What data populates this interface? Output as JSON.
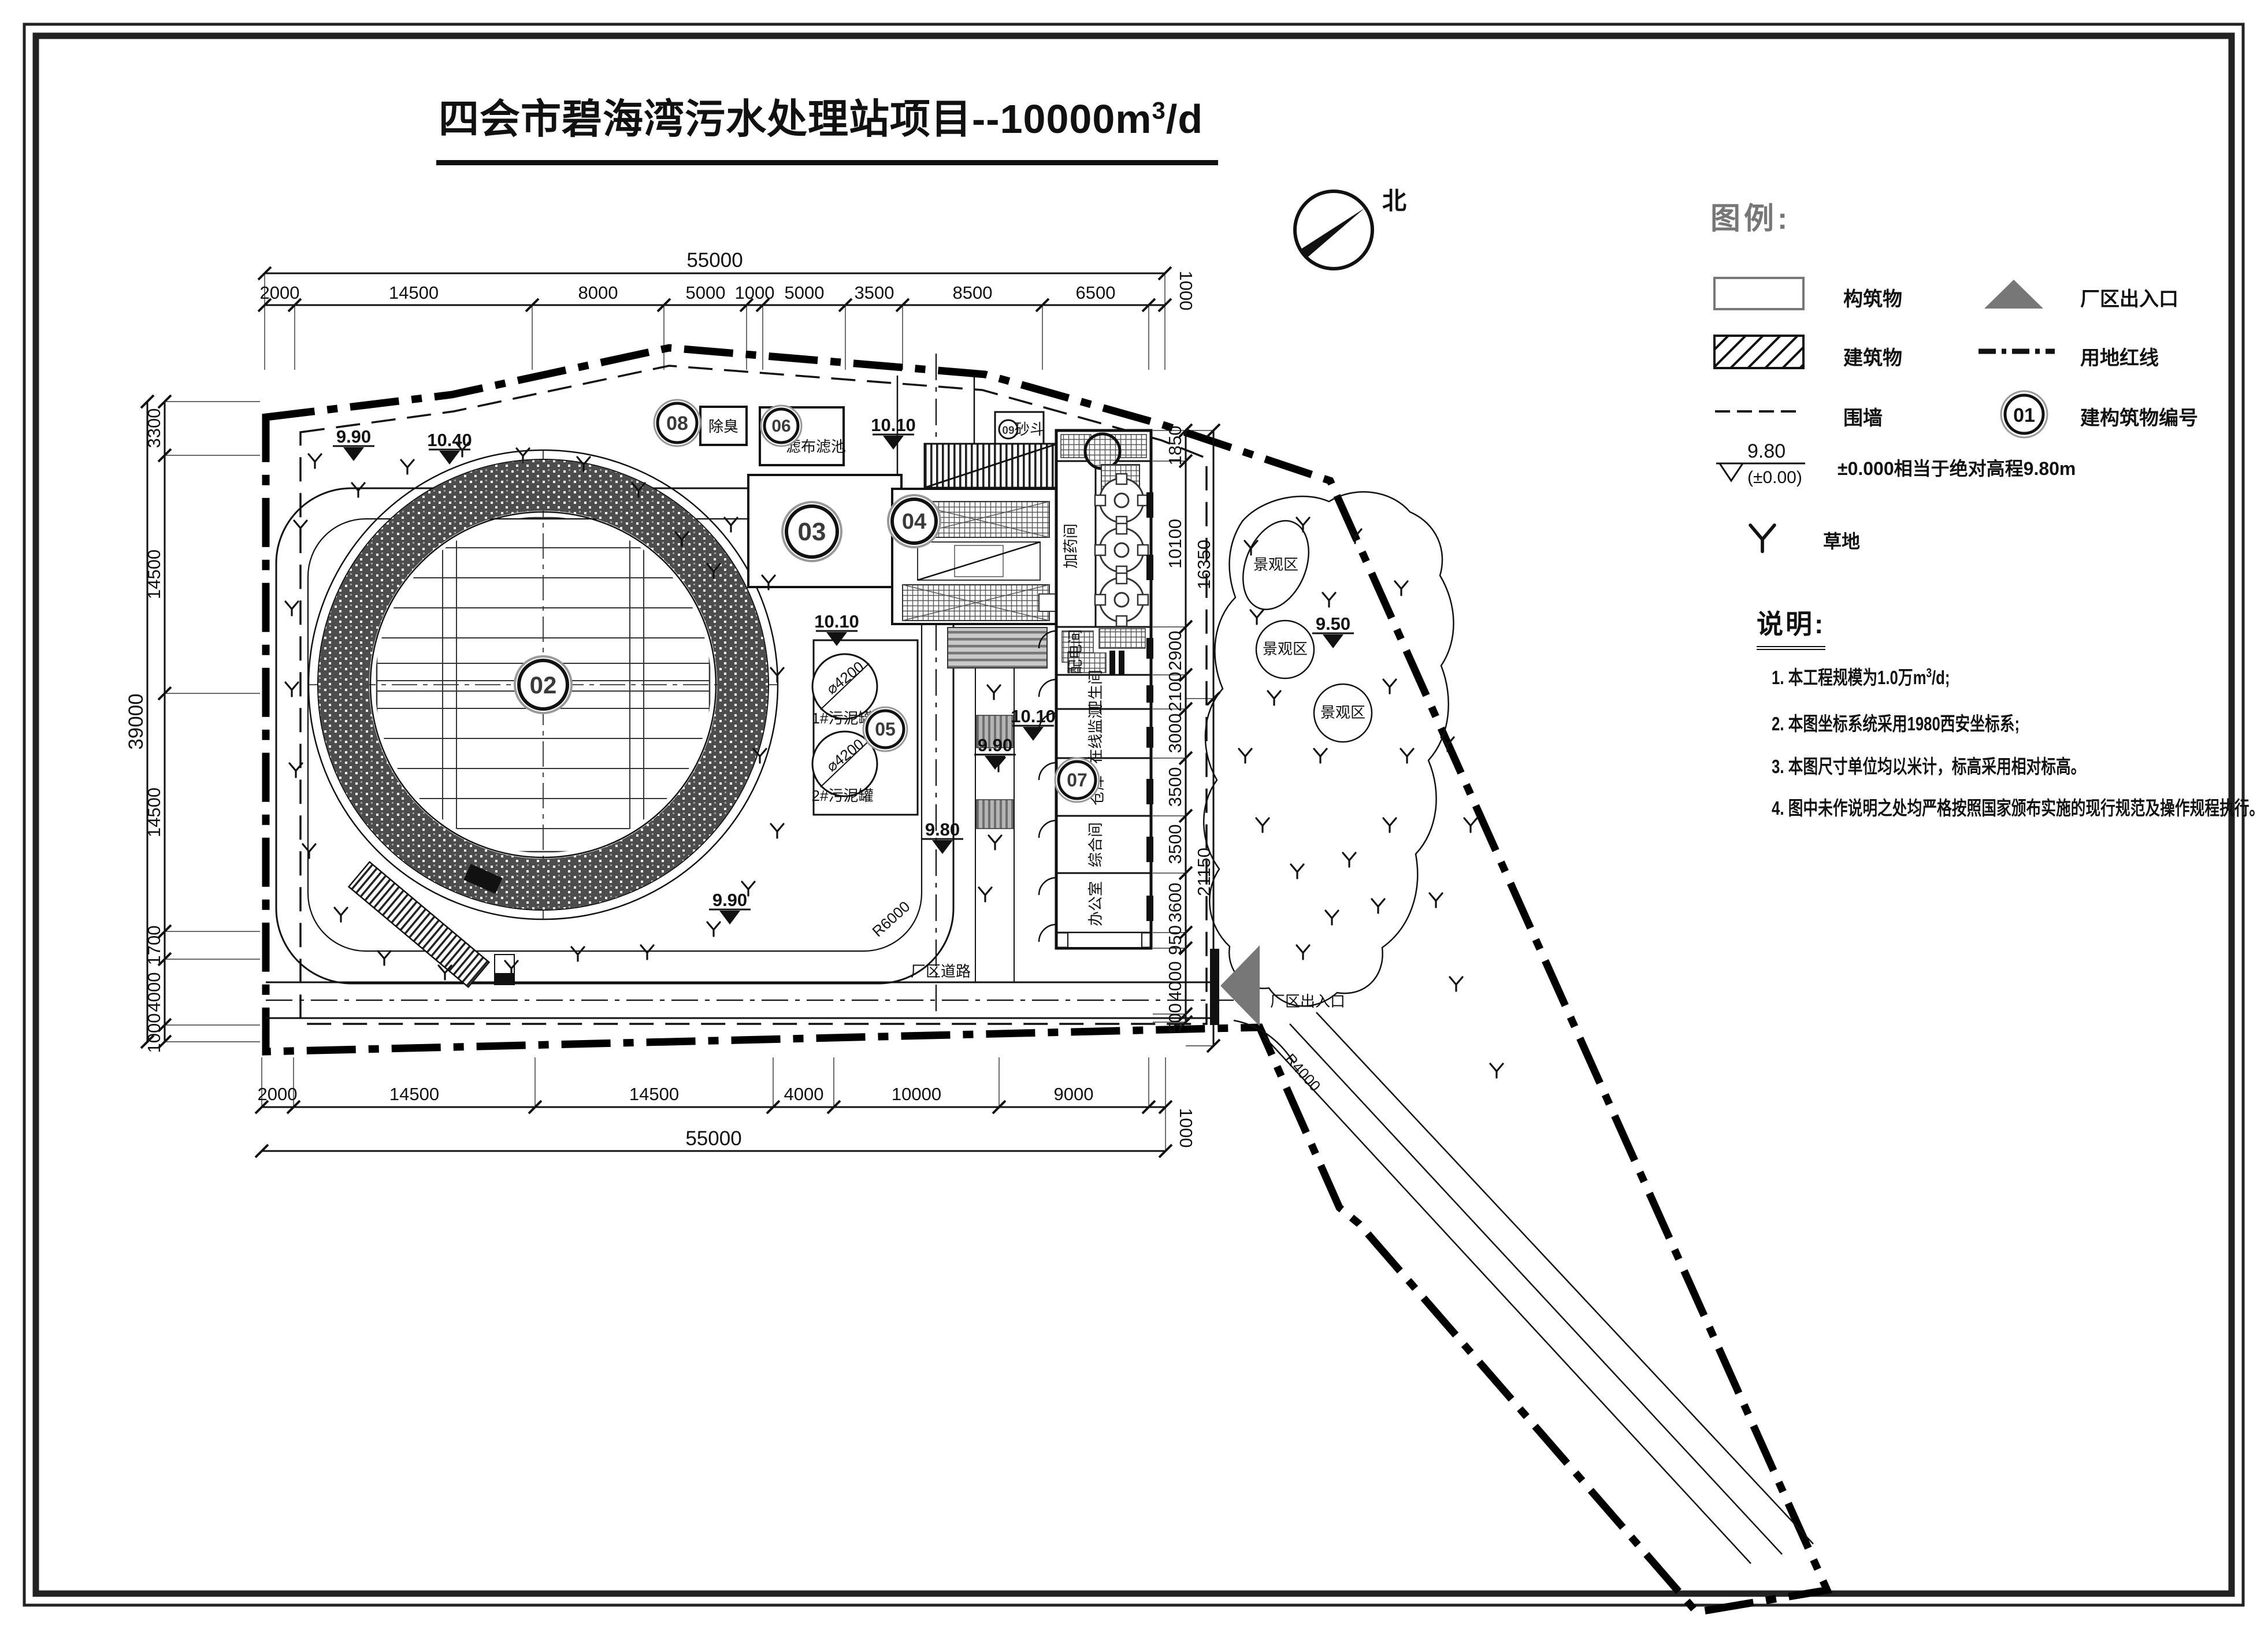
{
  "title": {
    "prefix": "四会市碧海湾污水处理站项目--10000m",
    "sup": "3",
    "suffix": "/d"
  },
  "compass": {
    "north": "北"
  },
  "legend": {
    "heading": "图例:",
    "structure": "构筑物",
    "building": "建筑物",
    "fence": "围墙",
    "entrance": "厂区出入口",
    "boundary": "用地红线",
    "numbering": "建构筑物编号",
    "number_sample": "01",
    "elev_value": "9.80",
    "elev_datum": "(±0.00)",
    "elev_desc": "±0.000相当于绝对高程9.80m",
    "grass": "草地"
  },
  "notes": {
    "heading": "说明:",
    "n1_prefix": "1.  本工程规模为1.0万m",
    "n1_sup": "3",
    "n1_suffix": "/d;",
    "n2": "2.  本图坐标系统采用1980西安坐标系;",
    "n3": "3.  本图尺寸单位均以米计，标高采用相对标高。",
    "n4": "4.  图中未作说明之处均严格按照国家颁布实施的现行规范及操作规程执行。"
  },
  "dims": {
    "top": {
      "total": "55000",
      "right_end": "1000",
      "segments": [
        "2000",
        "14500",
        "8000",
        "5000",
        "1000",
        "5000",
        "3500",
        "8500",
        "6500"
      ]
    },
    "bottom": {
      "total": "55000",
      "right_end": "1000",
      "segments": [
        "2000",
        "14500",
        "14500",
        "4000",
        "10000",
        "9000"
      ]
    },
    "left": {
      "total": "39000",
      "bottom_end": "1000",
      "segments": [
        "3300",
        "14500",
        "14500",
        "1700",
        "4000"
      ]
    },
    "right": {
      "outer": [
        "16350",
        "21150"
      ],
      "segments": [
        "1850",
        "10100",
        "2900",
        "2100",
        "3000",
        "3500",
        "3500",
        "3600",
        "950",
        "4000",
        "500"
      ]
    }
  },
  "plan": {
    "bubbles": {
      "b02": "02",
      "b03": "03",
      "b04": "04",
      "b05": "05",
      "b06": "06",
      "b07": "07",
      "b08": "08",
      "b09": "09"
    },
    "labels": {
      "deodor": "除臭",
      "cloth_filter": "滤布滤池",
      "sand_hopper": "砂斗",
      "dosing": "加药间",
      "power": "配电间",
      "toilet": "卫生间",
      "monitor": "在线监测",
      "warehouse": "仓库",
      "general": "综合间",
      "office": "办公室",
      "sludge1": "1#污泥罐",
      "sludge2": "2#污泥罐",
      "dia": "⌀4200",
      "road": "厂区道路",
      "gate": "厂区出入口",
      "scenic": "景观区",
      "r6000": "R6000",
      "r4000": "R4000"
    },
    "elev": {
      "e950": "9.50",
      "e980": "9.80",
      "e990": "9.90",
      "e1010": "10.10",
      "e1040": "10.40"
    }
  }
}
